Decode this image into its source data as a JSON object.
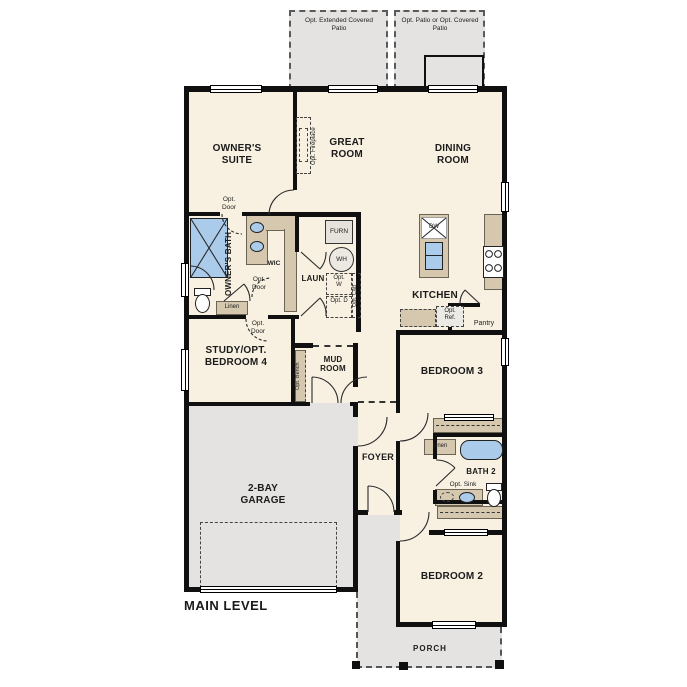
{
  "title": "MAIN LEVEL",
  "outdoor": {
    "patio_left": "Opt. Extended Covered Patio",
    "patio_right": "Opt. Patio or Opt. Covered Patio",
    "porch": "PORCH"
  },
  "rooms": {
    "owners_suite": "OWNER'S SUITE",
    "great_room": "GREAT ROOM",
    "dining_room": "DINING ROOM",
    "kitchen": "KITCHEN",
    "owners_bath": "OWNER'S BATH",
    "wic": "WIC",
    "laundry": "LAUN",
    "study": "STUDY/OPT. BEDROOM 4",
    "mud_room": "MUD ROOM",
    "bedroom3": "BEDROOM 3",
    "bath2": "BATH 2",
    "bedroom2": "BEDROOM 2",
    "foyer": "FOYER",
    "garage": "2-BAY GARAGE",
    "pantry": "Pantry"
  },
  "annotations": {
    "opt_door": "Opt. Door",
    "opt_fireplace": "Opt. Fireplace",
    "linen": "Linen",
    "furnace": "FURN",
    "water_heater": "WH",
    "opt_washer": "Opt. W",
    "opt_dryer": "Opt. D",
    "opt_cabinet": "Opt. Cab",
    "opt_bench": "Opt. Bench",
    "dishwasher": "DW",
    "opt_fridge": "Opt. Ref.",
    "opt_sink": "Opt. Sink"
  },
  "colors": {
    "floor": "#f8f1e2",
    "outdoor_gray": "#e4e3e1",
    "cabinet_tan": "#d5c8af",
    "fixture_blue": "#abcbea",
    "wall_black": "#101010"
  }
}
